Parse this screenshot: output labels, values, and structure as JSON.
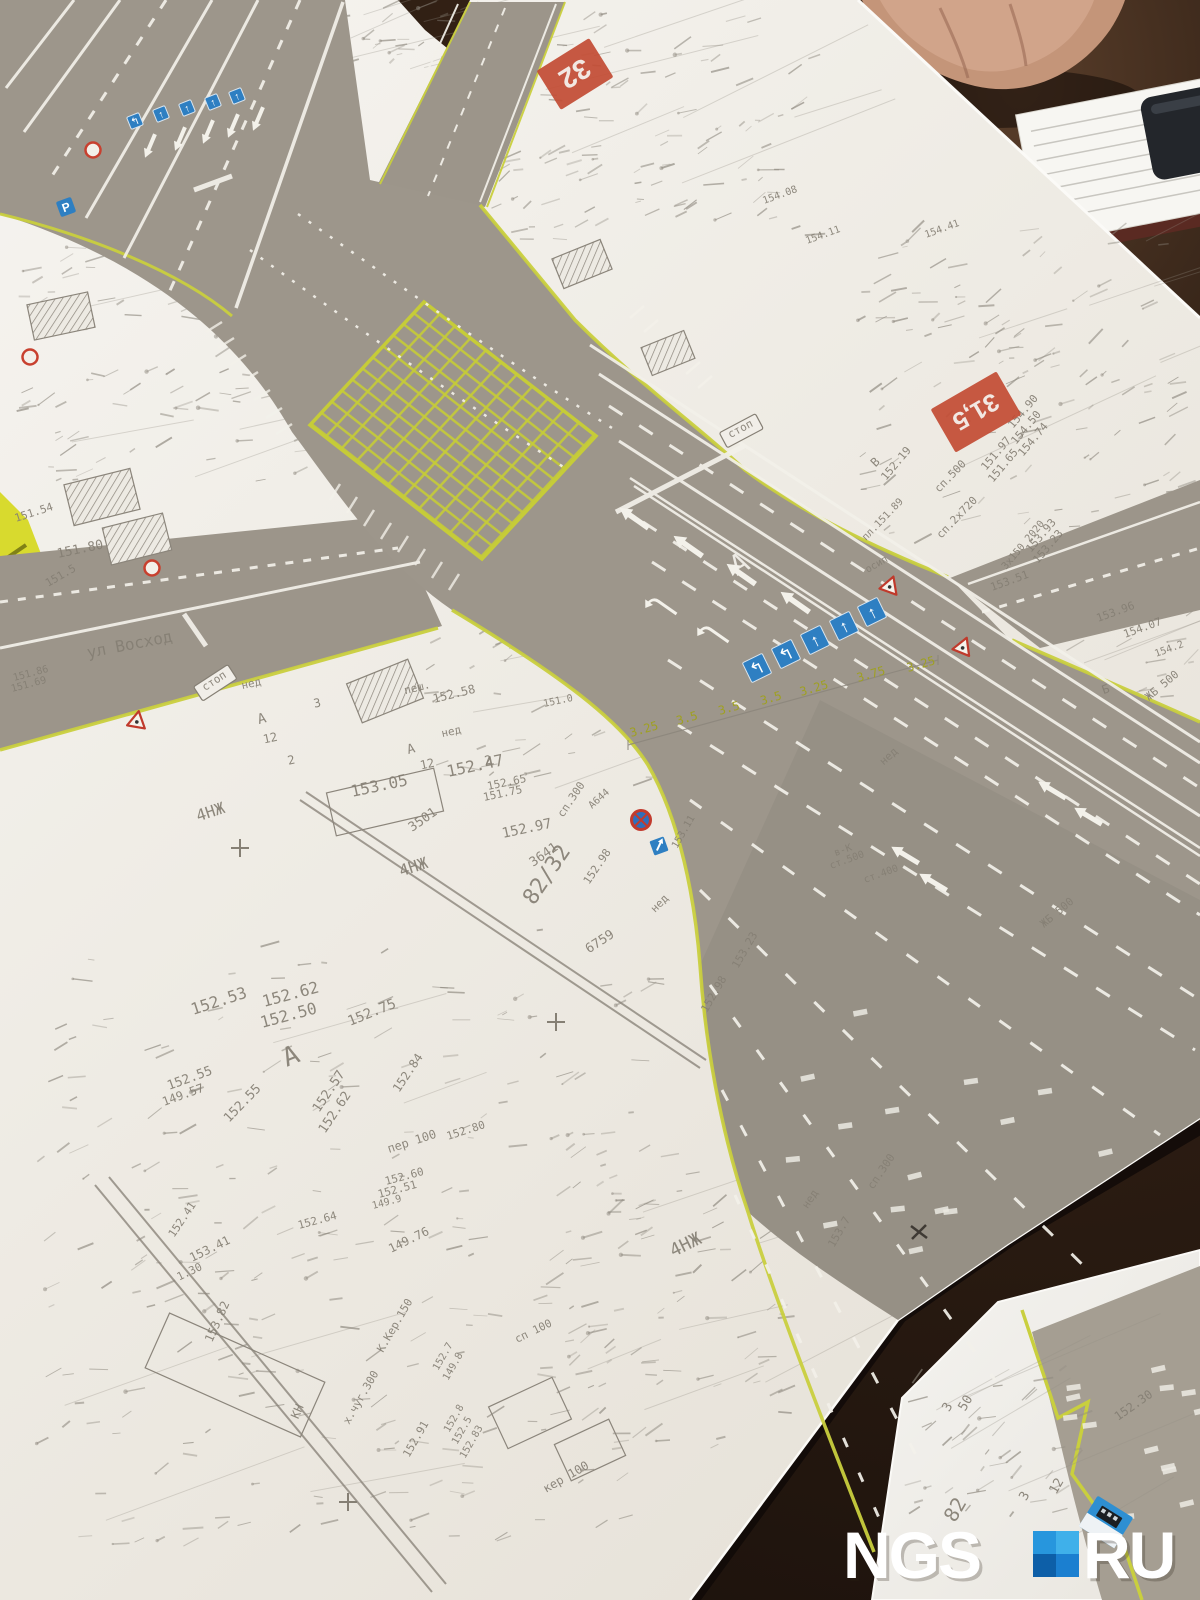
{
  "watermark": {
    "ngs": "NGS",
    "ru": "RU",
    "square_colors": {
      "tl": "#2796dd",
      "tr": "#3fb0ea",
      "bl": "#0d5fa8",
      "br": "#1b7fd0"
    }
  },
  "markers": [
    {
      "t": "32",
      "x": 575,
      "y": 74,
      "r": 148,
      "w": 62,
      "h": 46,
      "s": 28
    },
    {
      "t": "31,5",
      "x": 976,
      "y": 412,
      "r": 150,
      "w": 76,
      "h": 50,
      "s": 25
    }
  ],
  "sign_rows": [
    {
      "size": 13,
      "r": -22,
      "signs": [
        {
          "x": 135,
          "y": 121,
          "a": "↰"
        },
        {
          "x": 161,
          "y": 114,
          "a": "↑"
        },
        {
          "x": 187,
          "y": 108,
          "a": "↑"
        },
        {
          "x": 213,
          "y": 102,
          "a": "↑"
        },
        {
          "x": 237,
          "y": 96,
          "a": "↑"
        }
      ]
    },
    {
      "size": 22,
      "r": -26,
      "signs": [
        {
          "x": 757,
          "y": 668,
          "a": "↰"
        },
        {
          "x": 786,
          "y": 654,
          "a": "↰"
        },
        {
          "x": 815,
          "y": 640,
          "a": "↑"
        },
        {
          "x": 844,
          "y": 626,
          "a": "↑"
        },
        {
          "x": 872,
          "y": 612,
          "a": "↑"
        }
      ]
    }
  ],
  "misc_signs": {
    "parking": {
      "x": 66,
      "y": 207,
      "t": "P"
    },
    "no_stopping": {
      "x": 641,
      "y": 820
    },
    "blue_arrow": {
      "x": 659,
      "y": 846
    },
    "red_rings": [
      [
        93,
        150
      ],
      [
        30,
        357
      ],
      [
        152,
        568
      ]
    ],
    "triangles": [
      [
        890,
        586,
        20
      ],
      [
        963,
        647,
        22
      ],
      [
        137,
        721,
        10
      ]
    ],
    "bus": {
      "x": 1106,
      "y": 1522,
      "r": 32
    }
  },
  "yellow_widths": {
    "r": -16,
    "s": 12,
    "color": "#9fa022",
    "items": [
      {
        "t": "3.25",
        "x": 645,
        "y": 733
      },
      {
        "t": "3.5",
        "x": 688,
        "y": 722
      },
      {
        "t": "3.5",
        "x": 730,
        "y": 712
      },
      {
        "t": "3.5",
        "x": 772,
        "y": 702
      },
      {
        "t": "3.25",
        "x": 815,
        "y": 692
      },
      {
        "t": "3.75",
        "x": 872,
        "y": 678
      },
      {
        "t": "3.25",
        "x": 922,
        "y": 668
      }
    ]
  },
  "labels": [
    {
      "t": "ул Восход",
      "x": 88,
      "y": 658,
      "r": -11,
      "s": 16
    },
    {
      "t": "стоп",
      "x": 216,
      "y": 684,
      "r": -33,
      "s": 11,
      "b": 1
    },
    {
      "t": "стоп",
      "x": 742,
      "y": 432,
      "r": -28,
      "s": 11,
      "b": 1
    },
    {
      "t": "А",
      "x": 744,
      "y": 572,
      "r": -30,
      "s": 28,
      "c": "w"
    },
    {
      "t": "А",
      "x": 294,
      "y": 1064,
      "r": -22,
      "s": 26
    },
    {
      "t": "А",
      "x": 263,
      "y": 723,
      "r": -15,
      "s": 14
    },
    {
      "t": "А",
      "x": 412,
      "y": 753,
      "r": -15,
      "s": 13
    },
    {
      "t": "4НЖ",
      "x": 212,
      "y": 817,
      "r": -18,
      "s": 16
    },
    {
      "t": "4НЖ",
      "x": 415,
      "y": 872,
      "r": -18,
      "s": 16
    },
    {
      "t": "4НЖ",
      "x": 688,
      "y": 1250,
      "r": -26,
      "s": 18
    },
    {
      "t": "82/32",
      "x": 534,
      "y": 906,
      "r": -56,
      "s": 22
    },
    {
      "t": "пеш.",
      "x": 418,
      "y": 691,
      "r": -14,
      "s": 11
    },
    {
      "t": "152.58",
      "x": 434,
      "y": 703,
      "r": -14,
      "s": 12
    },
    {
      "t": "152.47",
      "x": 448,
      "y": 777,
      "r": -12,
      "s": 16
    },
    {
      "t": "153.05",
      "x": 352,
      "y": 797,
      "r": -12,
      "s": 16
    },
    {
      "t": "3501",
      "x": 425,
      "y": 823,
      "r": -35,
      "s": 13
    },
    {
      "t": "152.97",
      "x": 503,
      "y": 838,
      "r": -12,
      "s": 14
    },
    {
      "t": "3641",
      "x": 546,
      "y": 858,
      "r": -35,
      "s": 13
    },
    {
      "t": "6759",
      "x": 602,
      "y": 945,
      "r": -33,
      "s": 13
    },
    {
      "t": "сп.300",
      "x": 563,
      "y": 818,
      "r": -56,
      "s": 11
    },
    {
      "t": "сп.300",
      "x": 873,
      "y": 1190,
      "r": -56,
      "s": 11
    },
    {
      "t": "А644",
      "x": 601,
      "y": 801,
      "r": -42,
      "s": 10
    },
    {
      "t": "152.98",
      "x": 589,
      "y": 885,
      "r": -56,
      "s": 11
    },
    {
      "t": "нед",
      "x": 662,
      "y": 906,
      "r": -45,
      "s": 11
    },
    {
      "t": "нед",
      "x": 252,
      "y": 687,
      "r": -12,
      "s": 11
    },
    {
      "t": "нед",
      "x": 452,
      "y": 735,
      "r": -12,
      "s": 11
    },
    {
      "t": "нед",
      "x": 891,
      "y": 759,
      "r": -42,
      "s": 11
    },
    {
      "t": "нед",
      "x": 813,
      "y": 1201,
      "r": -56,
      "s": 11
    },
    {
      "t": "3",
      "x": 318,
      "y": 707,
      "r": -12,
      "s": 12
    },
    {
      "t": "12",
      "x": 271,
      "y": 742,
      "r": -12,
      "s": 12
    },
    {
      "t": "2",
      "x": 292,
      "y": 764,
      "r": -12,
      "s": 12
    },
    {
      "t": "12",
      "x": 428,
      "y": 768,
      "r": -12,
      "s": 12
    },
    {
      "t": "2",
      "x": 489,
      "y": 764,
      "r": -12,
      "s": 12
    },
    {
      "t": "152.65",
      "x": 488,
      "y": 790,
      "r": -12,
      "s": 11
    },
    {
      "t": "151.75",
      "x": 484,
      "y": 801,
      "r": -12,
      "s": 11
    },
    {
      "t": "В",
      "x": 878,
      "y": 465,
      "r": -45,
      "s": 12
    },
    {
      "t": "152.19",
      "x": 886,
      "y": 481,
      "r": -50,
      "s": 11
    },
    {
      "t": "сп.500",
      "x": 939,
      "y": 493,
      "r": -46,
      "s": 11
    },
    {
      "t": "сп.2х720",
      "x": 941,
      "y": 539,
      "r": -46,
      "s": 11
    },
    {
      "t": "пл.151.89",
      "x": 866,
      "y": 541,
      "r": -46,
      "s": 10
    },
    {
      "t": "151.97",
      "x": 986,
      "y": 471,
      "r": -50,
      "s": 11
    },
    {
      "t": "151.65",
      "x": 993,
      "y": 483,
      "r": -50,
      "s": 11
    },
    {
      "t": "154.50",
      "x": 1016,
      "y": 445,
      "r": -50,
      "s": 11
    },
    {
      "t": "154.74",
      "x": 1023,
      "y": 457,
      "r": -50,
      "s": 11
    },
    {
      "t": "153.93",
      "x": 1031,
      "y": 553,
      "r": -50,
      "s": 11
    },
    {
      "t": "153.23",
      "x": 1038,
      "y": 564,
      "r": -50,
      "s": 11
    },
    {
      "t": "3х150 2020",
      "x": 1006,
      "y": 570,
      "r": -50,
      "s": 10
    },
    {
      "t": "153.51",
      "x": 992,
      "y": 591,
      "r": -20,
      "s": 11
    },
    {
      "t": "осип",
      "x": 878,
      "y": 567,
      "r": -30,
      "s": 10
    },
    {
      "t": "153.96",
      "x": 1098,
      "y": 622,
      "r": -20,
      "s": 11
    },
    {
      "t": "154.07",
      "x": 1125,
      "y": 638,
      "r": -20,
      "s": 11
    },
    {
      "t": "154.2",
      "x": 1156,
      "y": 657,
      "r": -20,
      "s": 10
    },
    {
      "t": "ЖБ 500",
      "x": 1149,
      "y": 701,
      "r": -40,
      "s": 11
    },
    {
      "t": "ЖБ 500",
      "x": 1044,
      "y": 928,
      "r": -40,
      "s": 11
    },
    {
      "t": "Б",
      "x": 1107,
      "y": 693,
      "r": -20,
      "s": 12
    },
    {
      "t": "151.54",
      "x": 16,
      "y": 522,
      "r": -18,
      "s": 11
    },
    {
      "t": "151.80",
      "x": 58,
      "y": 558,
      "r": -12,
      "s": 13
    },
    {
      "t": "151.5",
      "x": 48,
      "y": 587,
      "r": -30,
      "s": 11
    },
    {
      "t": "151.86",
      "x": 14,
      "y": 681,
      "r": -15,
      "s": 10
    },
    {
      "t": "151.69",
      "x": 12,
      "y": 692,
      "r": -15,
      "s": 10
    },
    {
      "t": "151.0",
      "x": 544,
      "y": 707,
      "r": -12,
      "s": 10
    },
    {
      "t": "152.53",
      "x": 193,
      "y": 1015,
      "r": -18,
      "s": 16
    },
    {
      "t": "152.62",
      "x": 264,
      "y": 1007,
      "r": -15,
      "s": 16
    },
    {
      "t": "152.50",
      "x": 262,
      "y": 1028,
      "r": -15,
      "s": 16
    },
    {
      "t": "152.75",
      "x": 350,
      "y": 1026,
      "r": -22,
      "s": 14
    },
    {
      "t": "152.55",
      "x": 169,
      "y": 1090,
      "r": -20,
      "s": 13
    },
    {
      "t": "149.57",
      "x": 164,
      "y": 1106,
      "r": -20,
      "s": 12
    },
    {
      "t": "152.57",
      "x": 319,
      "y": 1113,
      "r": -56,
      "s": 13
    },
    {
      "t": "152.62",
      "x": 325,
      "y": 1134,
      "r": -56,
      "s": 13
    },
    {
      "t": "152.84",
      "x": 399,
      "y": 1093,
      "r": -56,
      "s": 12
    },
    {
      "t": "152.55",
      "x": 229,
      "y": 1123,
      "r": -46,
      "s": 13
    },
    {
      "t": "153.41",
      "x": 192,
      "y": 1262,
      "r": -26,
      "s": 12
    },
    {
      "t": "1.30",
      "x": 191,
      "y": 1275,
      "r": -26,
      "s": 11
    },
    {
      "t": "153.82",
      "x": 212,
      "y": 1343,
      "r": -66,
      "s": 12
    },
    {
      "t": "149.76",
      "x": 391,
      "y": 1253,
      "r": -26,
      "s": 12
    },
    {
      "t": "К.Кер.150",
      "x": 383,
      "y": 1353,
      "r": -60,
      "s": 11
    },
    {
      "t": "х.чуг.300",
      "x": 349,
      "y": 1425,
      "r": -60,
      "s": 11
    },
    {
      "t": "152.91",
      "x": 409,
      "y": 1458,
      "r": -60,
      "s": 11
    },
    {
      "t": "152.7",
      "x": 438,
      "y": 1371,
      "r": -60,
      "s": 10
    },
    {
      "t": "149.8",
      "x": 448,
      "y": 1381,
      "r": -60,
      "s": 10
    },
    {
      "t": "152.8",
      "x": 449,
      "y": 1433,
      "r": -60,
      "s": 10
    },
    {
      "t": "152.5",
      "x": 457,
      "y": 1445,
      "r": -60,
      "s": 10
    },
    {
      "t": "152.83",
      "x": 465,
      "y": 1459,
      "r": -60,
      "s": 10
    },
    {
      "t": "КН",
      "x": 301,
      "y": 1413,
      "r": -66,
      "s": 12
    },
    {
      "t": "пер 100",
      "x": 389,
      "y": 1153,
      "r": -18,
      "s": 12
    },
    {
      "t": "152.80",
      "x": 448,
      "y": 1140,
      "r": -18,
      "s": 11
    },
    {
      "t": "сп 100",
      "x": 517,
      "y": 1343,
      "r": -26,
      "s": 11
    },
    {
      "t": "кер 100",
      "x": 546,
      "y": 1493,
      "r": -30,
      "s": 12
    },
    {
      "t": "152.51",
      "x": 379,
      "y": 1198,
      "r": -15,
      "s": 11
    },
    {
      "t": "152.60",
      "x": 386,
      "y": 1185,
      "r": -15,
      "s": 11
    },
    {
      "t": "149.9",
      "x": 373,
      "y": 1209,
      "r": -15,
      "s": 10
    },
    {
      "t": "152.64",
      "x": 299,
      "y": 1229,
      "r": -15,
      "s": 11
    },
    {
      "t": "152.41",
      "x": 174,
      "y": 1238,
      "r": -56,
      "s": 11
    },
    {
      "t": "ст.500",
      "x": 831,
      "y": 869,
      "r": -20,
      "s": 10
    },
    {
      "t": "ст.400",
      "x": 865,
      "y": 883,
      "r": -20,
      "s": 10
    },
    {
      "t": "в-К",
      "x": 844,
      "y": 853,
      "r": -20,
      "s": 10
    },
    {
      "t": "153.23",
      "x": 738,
      "y": 969,
      "r": -60,
      "s": 11
    },
    {
      "t": "152.98",
      "x": 707,
      "y": 1013,
      "r": -60,
      "s": 11
    },
    {
      "t": "153.7",
      "x": 834,
      "y": 1248,
      "r": -60,
      "s": 11
    },
    {
      "t": "153.11",
      "x": 677,
      "y": 849,
      "r": -60,
      "s": 10
    },
    {
      "t": "154.08",
      "x": 764,
      "y": 204,
      "r": -20,
      "s": 10
    },
    {
      "t": "154.11",
      "x": 807,
      "y": 244,
      "r": -20,
      "s": 10
    },
    {
      "t": "154.41",
      "x": 926,
      "y": 238,
      "r": -20,
      "s": 10
    },
    {
      "t": "154.90",
      "x": 1013,
      "y": 429,
      "r": -50,
      "s": 11
    },
    {
      "t": "3",
      "x": 951,
      "y": 1409,
      "r": -60,
      "s": 13
    },
    {
      "t": "50",
      "x": 969,
      "y": 1405,
      "r": -60,
      "s": 13
    },
    {
      "t": "12",
      "x": 1060,
      "y": 1488,
      "r": -60,
      "s": 13
    },
    {
      "t": "3",
      "x": 1028,
      "y": 1498,
      "r": -60,
      "s": 13
    },
    {
      "t": "152.30",
      "x": 1118,
      "y": 1421,
      "r": -35,
      "s": 12
    },
    {
      "t": "82",
      "x": 961,
      "y": 1513,
      "r": -60,
      "s": 20
    }
  ],
  "crosses": [
    [
      240,
      848
    ],
    [
      556,
      1022
    ],
    [
      348,
      1502
    ]
  ],
  "dark_cross": [
    [
      919,
      1232
    ]
  ],
  "colors": {
    "label_gray": "#857f74",
    "label_white": "#f4f2ec",
    "label_dark": "#6e6962",
    "marker_red": "#c24b33",
    "sign_blue": "#2e7fc2",
    "line_yellow": "#c9cf3e"
  }
}
